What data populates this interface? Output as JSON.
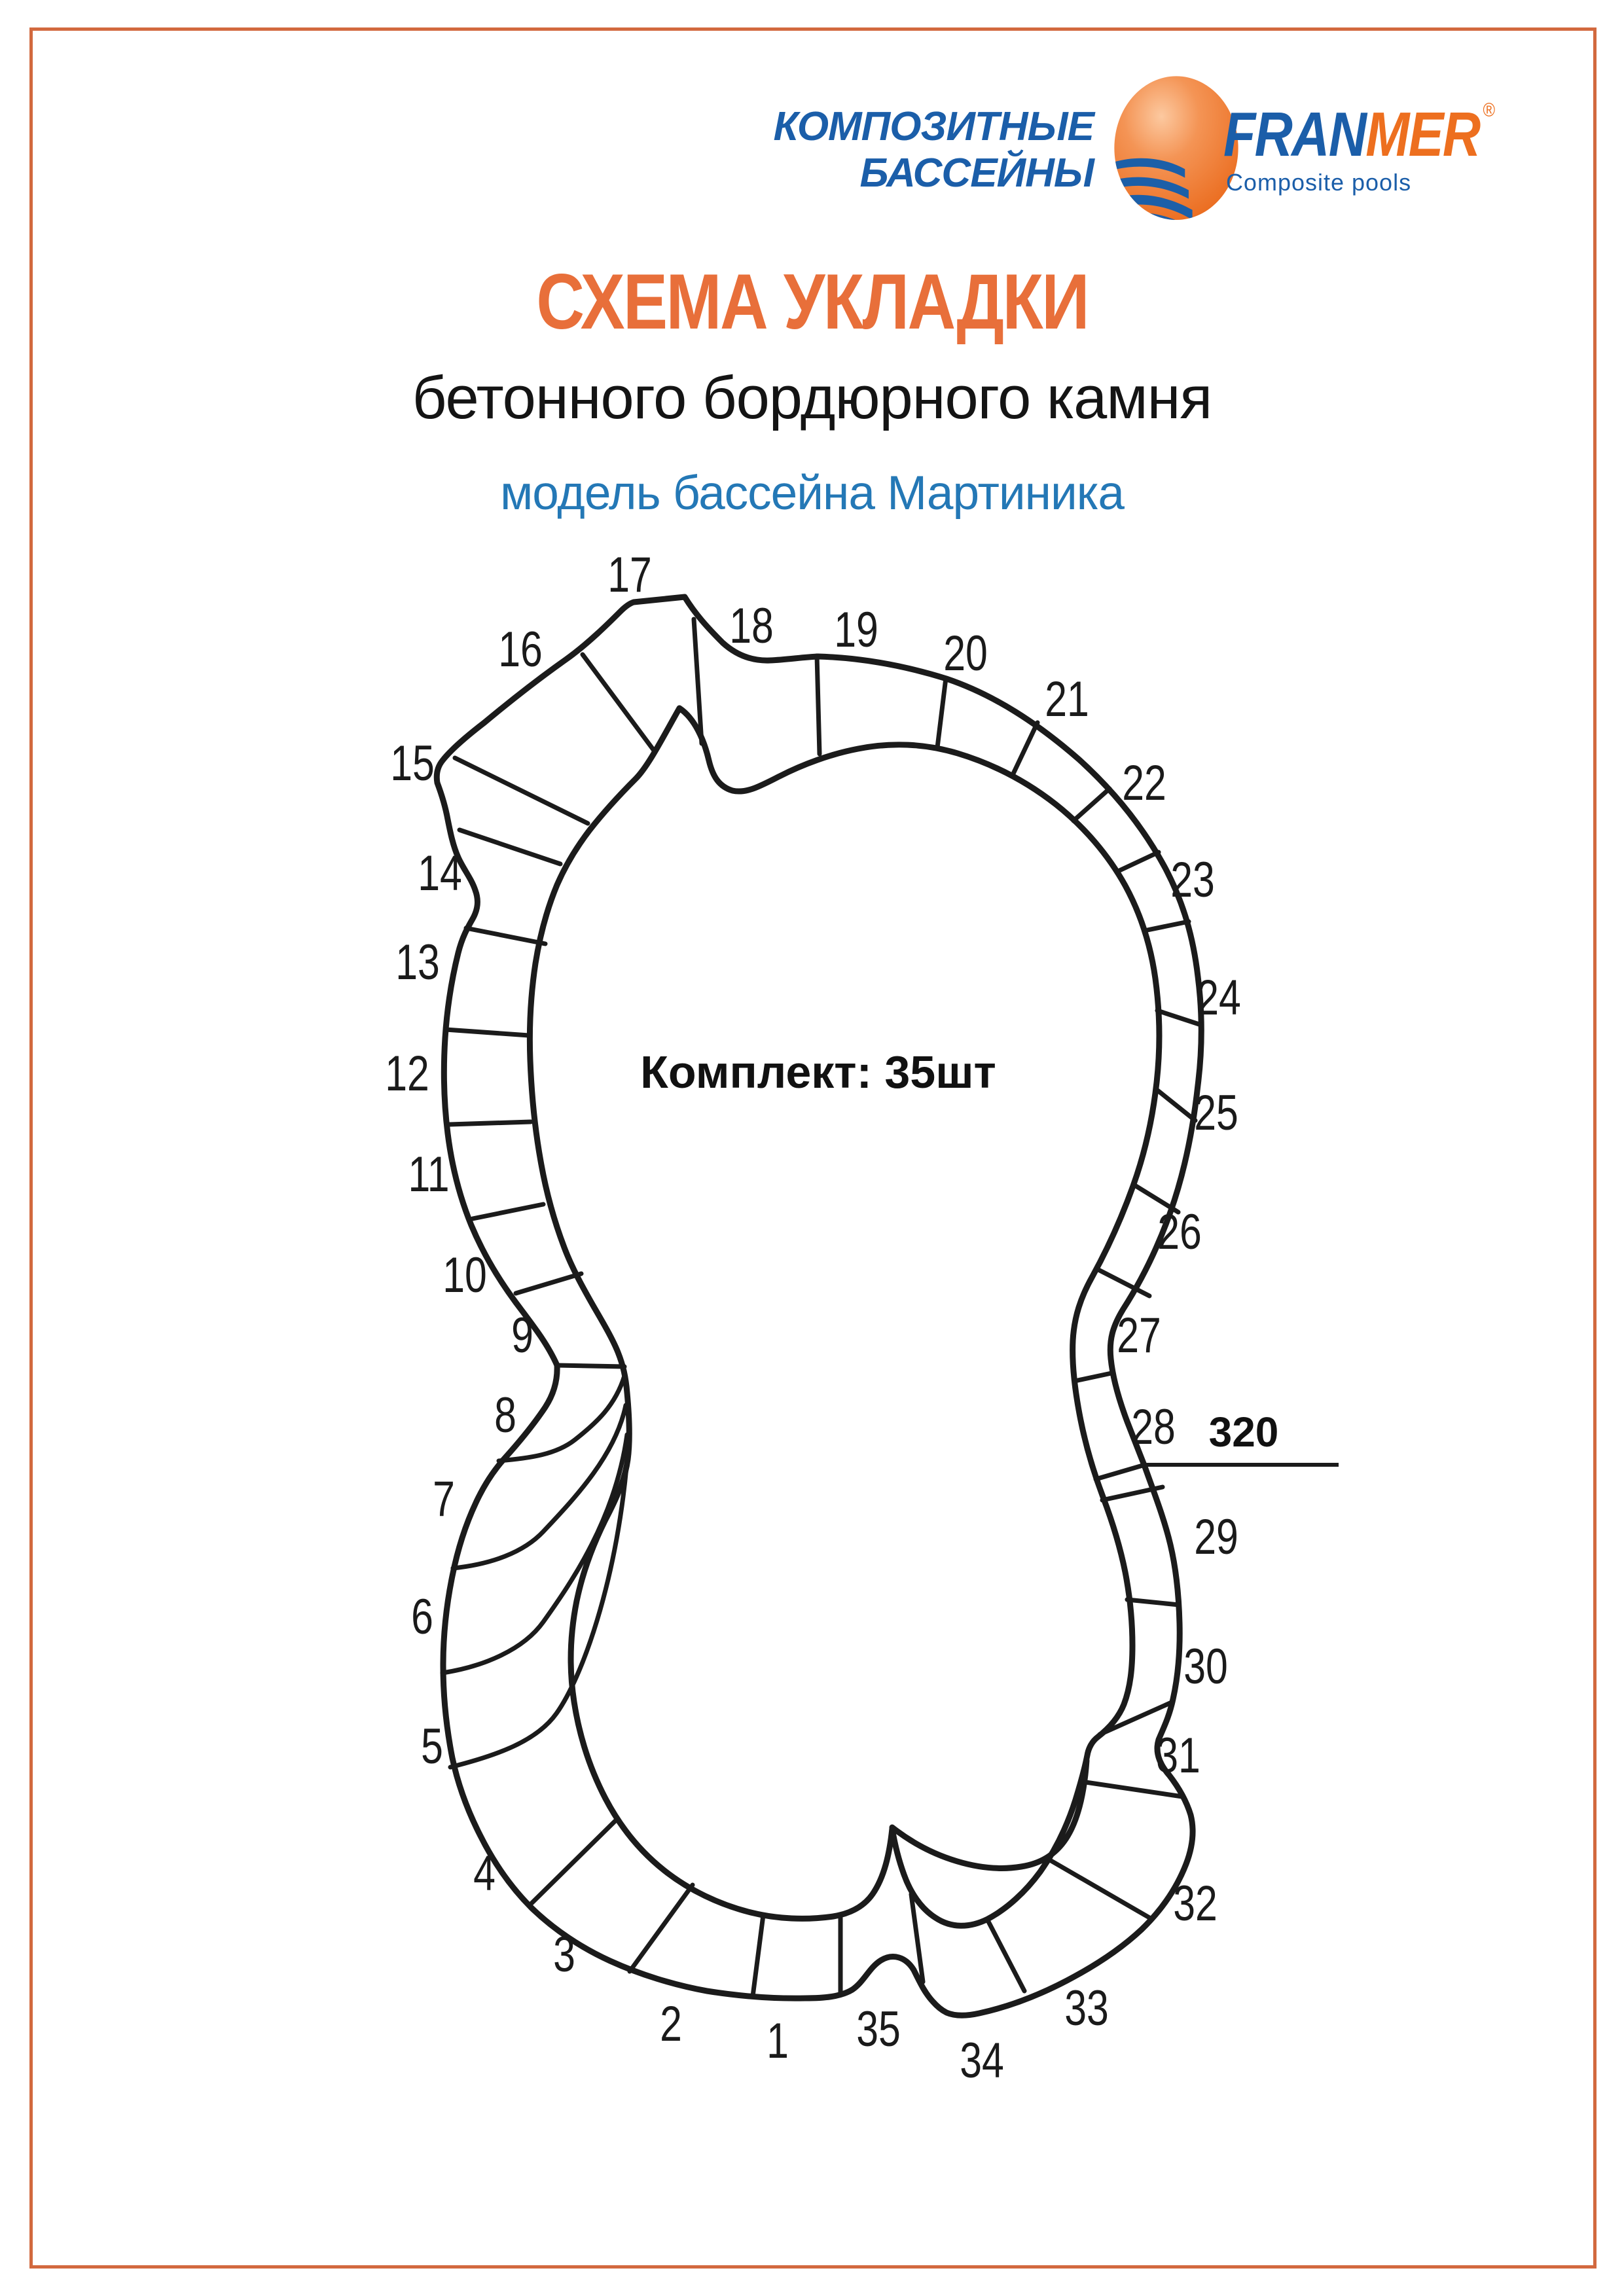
{
  "page": {
    "border_color": "#D2693E",
    "background": "#FFFFFF"
  },
  "logo": {
    "company_line1": "КОМПОЗИТНЫЕ",
    "company_line2": "БАССЕЙНЫ",
    "brand_part1": "FRAN",
    "brand_part2": "MER",
    "registered_mark": "®",
    "tagline": "Composite pools",
    "colors": {
      "blue": "#1B5EA9",
      "orange": "#ED6F1F"
    }
  },
  "titles": {
    "main": "СХЕМА УКЛАДКИ",
    "subtitle": "бетонного бордюрного камня",
    "model": "модель бассейна Мартиника",
    "main_color": "#E86F3A",
    "model_color": "#2478B6"
  },
  "diagram": {
    "kit_label": "Комплект: 35шт",
    "dimension_label": "320",
    "segment_count": 35,
    "segment_numbers": [
      "1",
      "2",
      "3",
      "4",
      "5",
      "6",
      "7",
      "8",
      "9",
      "10",
      "11",
      "12",
      "13",
      "14",
      "15",
      "16",
      "17",
      "18",
      "19",
      "20",
      "21",
      "22",
      "23",
      "24",
      "25",
      "26",
      "27",
      "28",
      "29",
      "30",
      "31",
      "32",
      "33",
      "34",
      "35"
    ]
  }
}
